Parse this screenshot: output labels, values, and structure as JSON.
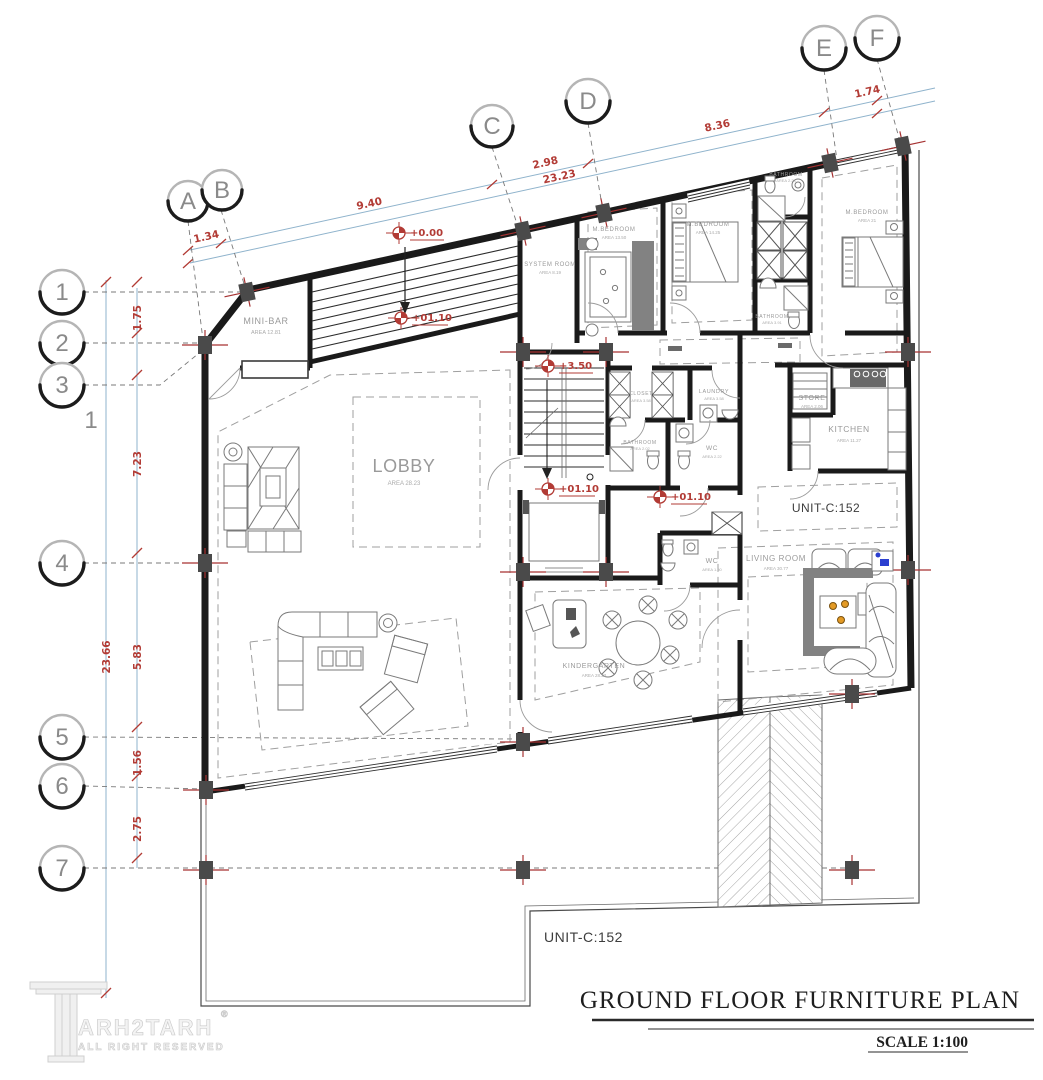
{
  "plan": {
    "grid_columns": [
      "A",
      "B",
      "C",
      "D",
      "E",
      "F"
    ],
    "grid_rows": [
      "1",
      "2",
      "3",
      "4",
      "5",
      "6",
      "7"
    ],
    "axis_note": "1",
    "dims_top": [
      "1.34",
      "9.40",
      "2.98",
      "23.23",
      "8.36",
      "1.74"
    ],
    "dims_left": [
      "1.75",
      "7.23",
      "23.66",
      "5.83",
      "1.56",
      "2.75"
    ],
    "elevations": [
      "+0.00",
      "+01.10",
      "+3.50",
      "+01.10",
      "+01.10"
    ],
    "rooms": [
      {
        "name": "MINI-BAR",
        "area": "AREA 12.81"
      },
      {
        "name": "LOBBY",
        "area": "AREA 28.23"
      },
      {
        "name": "SYSTEM ROOM",
        "area": "AREA 8.19"
      },
      {
        "name": "M.BEDROOM",
        "area": "AREA 13.50"
      },
      {
        "name": "M.BEDROOM",
        "area": "AREA 14.25"
      },
      {
        "name": "BATHROOM",
        "area": "AREA 2.23"
      },
      {
        "name": "M.BEDROOM",
        "area": "AREA 21"
      },
      {
        "name": "BATHROOM",
        "area": "AREA 3.91"
      },
      {
        "name": "CLOSET",
        "area": "AREA 3.58"
      },
      {
        "name": "LAUNDRY",
        "area": "AREA 3.58"
      },
      {
        "name": "BATHROOM",
        "area": "AREA 2.02"
      },
      {
        "name": "WC",
        "area": "AREA 2.22"
      },
      {
        "name": "STORE",
        "area": "AREA 2.06"
      },
      {
        "name": "KITCHEN",
        "area": "AREA 11.27"
      },
      {
        "name": "WC",
        "area": "AREA 1.50"
      },
      {
        "name": "KINDERGARTEN",
        "area": "AREA 28.23"
      },
      {
        "name": "LIVING ROOM",
        "area": "AREA 30.77"
      }
    ],
    "unit_label_interior": "UNIT-C:152",
    "unit_label_exterior": "UNIT-C:152"
  },
  "title_block": {
    "title": "GROUND FLOOR FURNITURE PLAN",
    "scale": "SCALE 1:100"
  },
  "watermark": {
    "brand": "ARH2TARH",
    "registered": "®",
    "tagline": "ALL RIGHT RESERVED"
  },
  "colors": {
    "dimension_red": "#b23b35",
    "construction_blue": "#8fb3cc",
    "wall_black": "#1a1a1a",
    "column_gray": "#4a4a4a",
    "accent_orange": "#e39a25",
    "accent_blue": "#2b3fd0"
  }
}
